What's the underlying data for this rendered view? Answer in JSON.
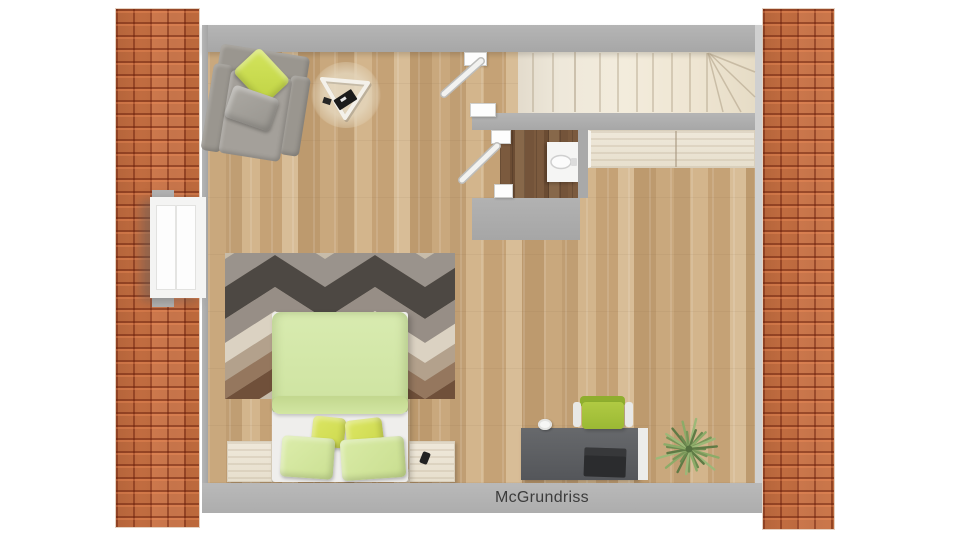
{
  "caption": {
    "text": "McGrundriss"
  },
  "floorplan": {
    "view": "top-down 3D rendered attic floor plan",
    "rooms": [
      {
        "name": "living-bedroom",
        "floor": "light oak parquet"
      },
      {
        "name": "bathroom",
        "floor": "dark walnut parquet",
        "fixtures": [
          "wall-mounted sink"
        ]
      },
      {
        "name": "stairwell",
        "feature": "straight run with winder treads at right"
      }
    ],
    "architecture": [
      "orange roof tile strip left",
      "orange roof tile strip right",
      "gray perimeter walls",
      "white window in left wall",
      "two white interior doors shown open",
      "kitchenette counter against north wall"
    ],
    "furniture": [
      "gray armchair with chartreuse cushion",
      "triangular coffee table on round rug",
      "double bed with green duvet and four green pillows",
      "geometric chevron area rug",
      "two whitewashed nightstands",
      "smartphone on right nightstand",
      "dark gray desk with laptop and white cup",
      "green swivel desk chair",
      "potted green plant"
    ],
    "colors": {
      "roof_tile": "#c8703f",
      "wall_gray": "#adadad",
      "floor_oak": "#c7a67b",
      "bath_floor": "#7a5a3e",
      "stair_cream": "#ece4d4",
      "duvet_green": "#d3e7a6",
      "pillow_chartreuse": "#d8e25e",
      "desk_chair_green": "#a5c23e",
      "desk_gray": "#5d5f62",
      "caption_text": "#3c3c3c",
      "background": "#ffffff"
    }
  }
}
